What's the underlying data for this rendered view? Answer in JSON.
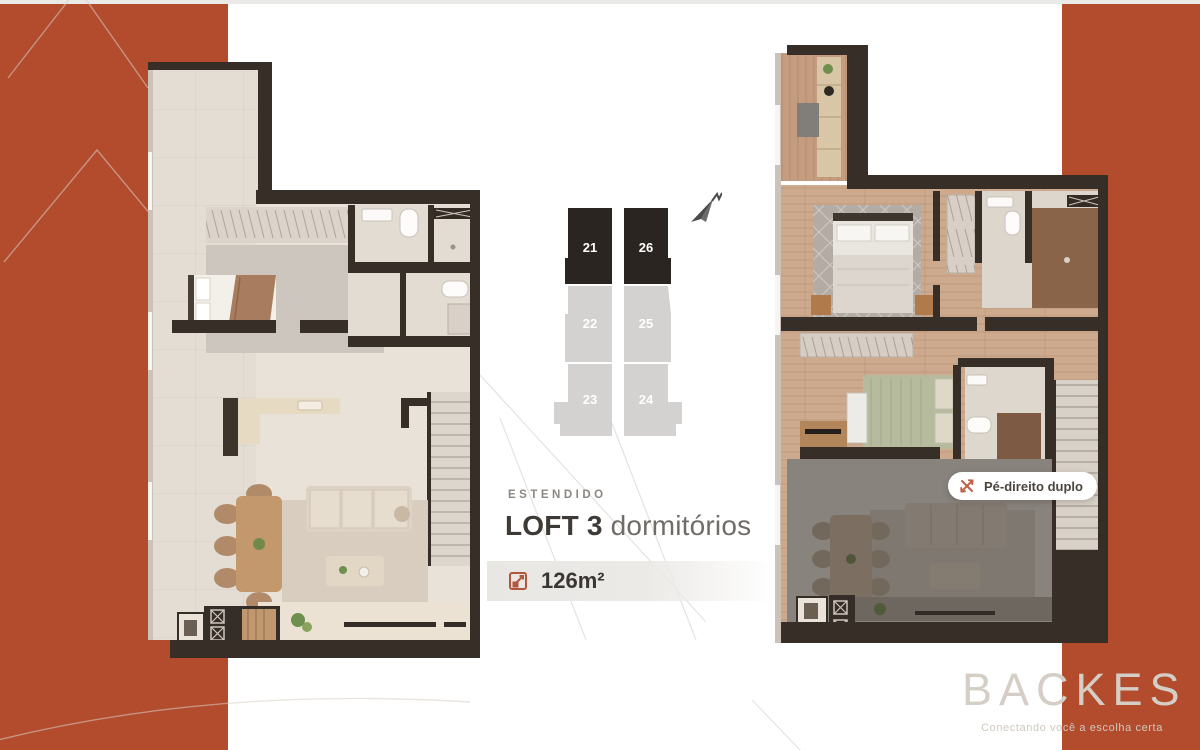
{
  "colors": {
    "accent_terracotta": "#b24c2d",
    "stack_selected": "#2b2521",
    "stack_unselected": "#d3d2d0",
    "wall_dark": "#382e28",
    "logo_gray": "#d5cec6"
  },
  "stack": {
    "units": [
      {
        "label": "21",
        "state": "selected"
      },
      {
        "label": "22",
        "state": "unselected"
      },
      {
        "label": "23",
        "state": "unselected"
      },
      {
        "label": "26",
        "state": "selected"
      },
      {
        "label": "25",
        "state": "unselected"
      },
      {
        "label": "24",
        "state": "unselected"
      }
    ],
    "compass_icon": "north-arrow-icon"
  },
  "info": {
    "tag": "ESTENDIDO",
    "title_strong": "LOFT 3",
    "title_light": " dormitórios",
    "area": "126m²",
    "area_icon": "area-expand-icon"
  },
  "badge": {
    "label": "Pé-direito duplo",
    "icon": "double-height-icon"
  },
  "brand": {
    "logo": "BACKES",
    "tagline": "Conectando você a escolha certa"
  },
  "floorplans": {
    "left": "lower-level-floor-plan",
    "right": "upper-level-floor-plan"
  }
}
